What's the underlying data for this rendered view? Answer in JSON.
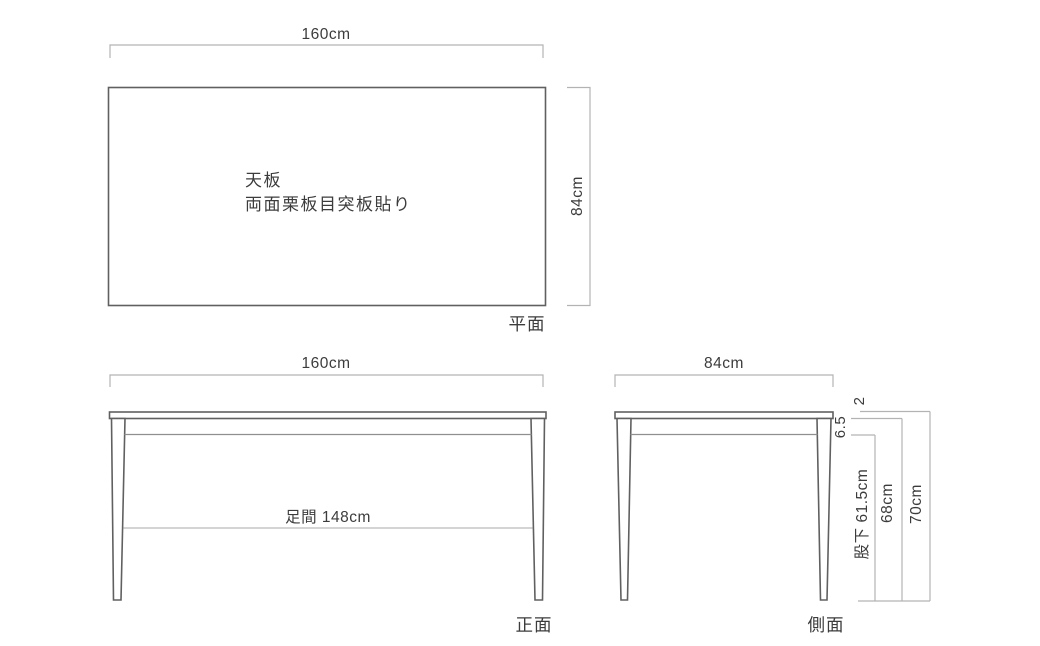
{
  "colors": {
    "background": "#ffffff",
    "outline": "#606060",
    "dimension_line": "#b3b3b3",
    "text": "#3c3c3c"
  },
  "views": {
    "top": {
      "label": "平面",
      "width_dim": "160cm",
      "depth_dim": "84cm",
      "tabletop_note_line1": "天板",
      "tabletop_note_line2": "両面栗板目突板貼り"
    },
    "front": {
      "label": "正面",
      "width_dim": "160cm",
      "leg_span_dim": "足間 148cm"
    },
    "side": {
      "label": "側面",
      "depth_dim": "84cm",
      "top_thickness_dim": "2",
      "apron_height_dim": "6.5",
      "leg_clearance_dim": "股下 61.5cm",
      "height_under_top_dim": "68cm",
      "total_height_dim": "70cm"
    }
  }
}
